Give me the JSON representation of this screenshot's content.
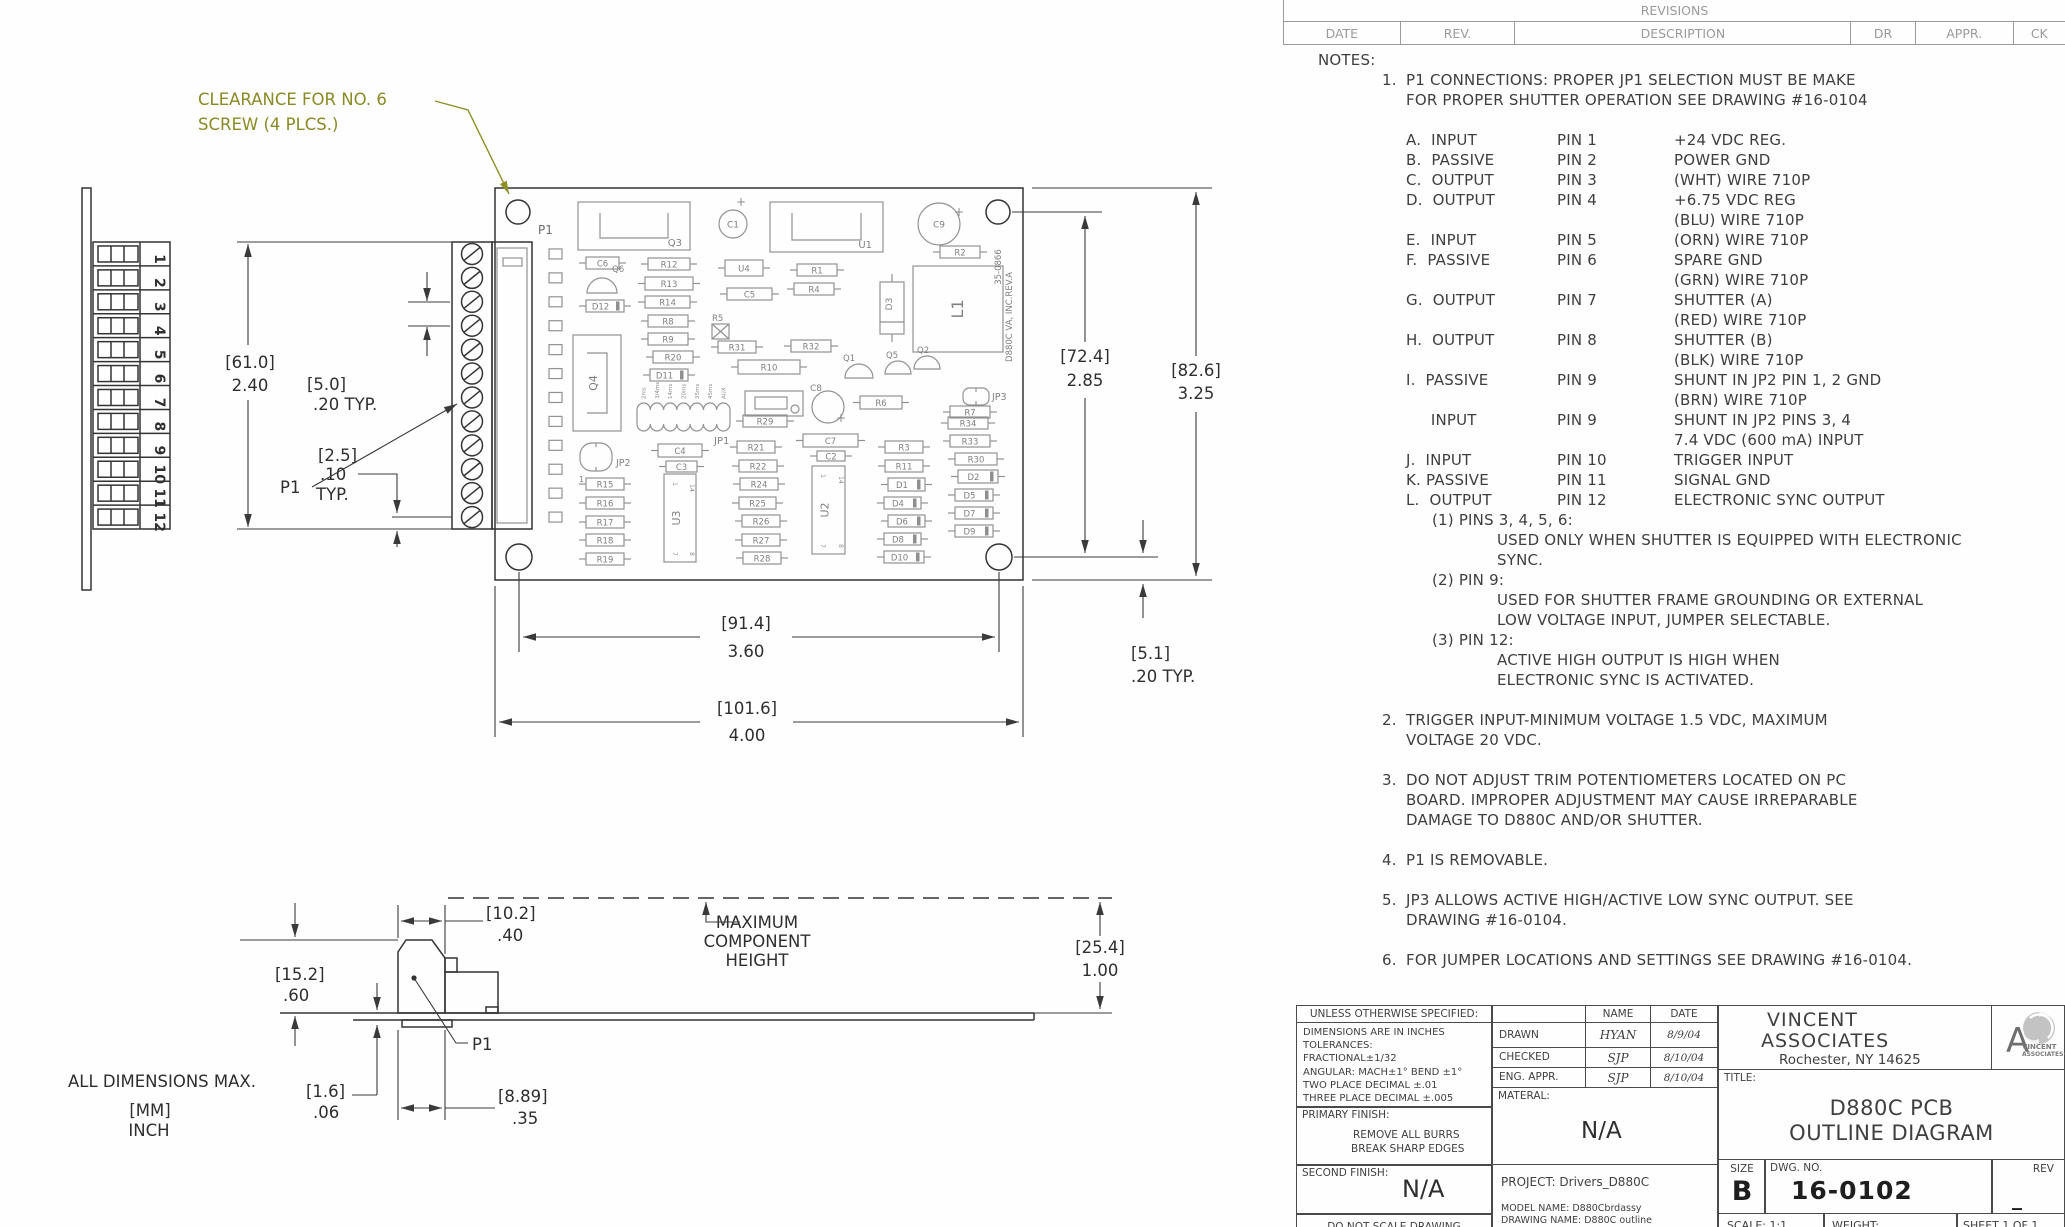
{
  "revisions": {
    "title": "REVISIONS",
    "columns": [
      "DATE",
      "REV.",
      "DESCRIPTION",
      "DR",
      "APPR.",
      "CK"
    ]
  },
  "callout": {
    "line1": "CLEARANCE FOR NO. 6",
    "line2": "SCREW (4 PLCS.)"
  },
  "labels": {
    "p1_main": "P1",
    "p1_left": "P1",
    "p1_side": "P1",
    "all_dims": "ALL DIMENSIONS MAX.",
    "mm": "[MM]",
    "inch": "INCH",
    "maxh1": "MAXIMUM",
    "maxh2": "COMPONENT",
    "maxh3": "HEIGHT"
  },
  "dims": {
    "d61_mm": "[61.0]",
    "d61_in": "2.40",
    "d5_mm": "[5.0]",
    "d5_in": ".20   TYP.",
    "d25_mm": "[2.5]",
    "d25_in": ".10",
    "d25_typ": "TYP.",
    "d72_mm": "[72.4]",
    "d72_in": "2.85",
    "d82_mm": "[82.6]",
    "d82_in": "3.25",
    "d91_mm": "[91.4]",
    "d91_in": "3.60",
    "d101_mm": "[101.6]",
    "d101_in": "4.00",
    "d51_mm": "[5.1]",
    "d51_in": ".20  TYP.",
    "d10_mm": "[10.2]",
    "d10_in": ".40",
    "d15_mm": "[15.2]",
    "d15_in": ".60",
    "d16_mm": "[1.6]",
    "d16_in": ".06",
    "d889_mm": "[8.89]",
    "d889_in": ".35",
    "d254_mm": "[25.4]",
    "d254_in": "1.00"
  },
  "connector_numbers": [
    "1",
    "2",
    "3",
    "4",
    "5",
    "6",
    "7",
    "8",
    "9",
    "10",
    "11",
    "12"
  ],
  "pcb": {
    "edge_text1": "35-0866",
    "edge_text2": "D880C  VA, INC.REV.A",
    "jp1_ticks": [
      "2ms",
      "3/4ms",
      "14ms",
      "20ms",
      "35ms",
      "45ms",
      "AUX"
    ],
    "components": [
      {
        "r": "Q3",
        "t": "ic",
        "x": 578,
        "y": 202,
        "w": 112,
        "h": 48,
        "bracket": true,
        "lx": 682,
        "ly": 246
      },
      {
        "r": "U1",
        "t": "ic",
        "x": 770,
        "y": 202,
        "w": 113,
        "h": 50,
        "bracket": true,
        "lx": 872,
        "ly": 248
      },
      {
        "r": "C1",
        "t": "ecap",
        "x": 733,
        "y": 224,
        "rad": 14,
        "px": 741,
        "py": 206
      },
      {
        "r": "C9",
        "t": "ecap",
        "x": 939,
        "y": 224,
        "rad": 21,
        "px": 959,
        "py": 216
      },
      {
        "r": "R2",
        "t": "res",
        "x": 940,
        "y": 246,
        "w": 40,
        "h": 12
      },
      {
        "r": "U4",
        "t": "cap",
        "x": 725,
        "y": 260,
        "w": 38,
        "h": 16
      },
      {
        "r": "C5",
        "t": "cap",
        "x": 727,
        "y": 288,
        "w": 45,
        "h": 12
      },
      {
        "r": "R1",
        "t": "res",
        "x": 797,
        "y": 264,
        "w": 40,
        "h": 12
      },
      {
        "r": "R4",
        "t": "res",
        "x": 794,
        "y": 283,
        "w": 40,
        "h": 12
      },
      {
        "r": "D3",
        "t": "vdiode",
        "x": 880,
        "y": 282,
        "w": 24,
        "h": 52
      },
      {
        "r": "L1",
        "t": "coil",
        "x": 913,
        "y": 266,
        "w": 90,
        "h": 86
      },
      {
        "r": "C6",
        "t": "cap",
        "x": 586,
        "y": 257,
        "w": 33,
        "h": 12
      },
      {
        "r": "Q6",
        "t": "semi",
        "x": 602,
        "y": 293,
        "rad": 15,
        "lx": 612,
        "ly": 272
      },
      {
        "r": "D12",
        "t": "diode",
        "x": 586,
        "y": 300,
        "w": 38,
        "h": 12
      },
      {
        "r": "R12",
        "t": "res",
        "x": 648,
        "y": 258,
        "w": 42,
        "h": 12
      },
      {
        "r": "R13",
        "t": "res",
        "x": 645,
        "y": 277,
        "w": 48,
        "h": 13
      },
      {
        "r": "R14",
        "t": "res",
        "x": 645,
        "y": 296,
        "w": 45,
        "h": 12
      },
      {
        "r": "R8",
        "t": "res",
        "x": 648,
        "y": 315,
        "w": 40,
        "h": 12
      },
      {
        "r": "R5",
        "t": "xbox",
        "x": 712,
        "y": 324,
        "w": 17,
        "h": 15,
        "lx": 712,
        "ly": 321
      },
      {
        "r": "Q4",
        "t": "icv",
        "x": 573,
        "y": 335,
        "w": 48,
        "h": 96
      },
      {
        "r": "R9",
        "t": "res",
        "x": 648,
        "y": 333,
        "w": 40,
        "h": 12
      },
      {
        "r": "R20",
        "t": "res",
        "x": 653,
        "y": 351,
        "w": 40,
        "h": 12
      },
      {
        "r": "D11",
        "t": "diode",
        "x": 650,
        "y": 369,
        "w": 38,
        "h": 12
      },
      {
        "r": "R31",
        "t": "res",
        "x": 718,
        "y": 341,
        "w": 38,
        "h": 12
      },
      {
        "r": "R32",
        "t": "res",
        "x": 791,
        "y": 340,
        "w": 40,
        "h": 12
      },
      {
        "r": "R10",
        "t": "res",
        "x": 738,
        "y": 360,
        "w": 62,
        "h": 14
      },
      {
        "r": "Q1",
        "t": "semi",
        "x": 859,
        "y": 378,
        "rad": 14,
        "lx": 843,
        "ly": 361
      },
      {
        "r": "Q5",
        "t": "semi",
        "x": 898,
        "y": 374,
        "rad": 13,
        "lx": 886,
        "ly": 358
      },
      {
        "r": "Q2",
        "t": "semi",
        "x": 927,
        "y": 369,
        "rad": 13,
        "lx": 917,
        "ly": 353
      },
      {
        "t": "trim",
        "x": 745,
        "y": 391,
        "w": 58,
        "h": 25
      },
      {
        "r": "C8",
        "t": "ecap",
        "x": 828,
        "y": 407,
        "rad": 16,
        "px": 841,
        "py": 422,
        "lx": 810,
        "ly": 391
      },
      {
        "r": "R6",
        "t": "res",
        "x": 860,
        "y": 396,
        "w": 42,
        "h": 13
      },
      {
        "r": "JP3",
        "t": "jmp",
        "x": 963,
        "y": 388,
        "w": 26,
        "h": 17,
        "lx": 992,
        "ly": 400
      },
      {
        "r": "R7",
        "t": "res",
        "x": 950,
        "y": 406,
        "w": 40,
        "h": 12
      },
      {
        "r": "JP1",
        "t": "jp1",
        "x": 637,
        "y": 403,
        "w": 93,
        "h": 28,
        "lx": 714,
        "ly": 444
      },
      {
        "r": "R29",
        "t": "res",
        "x": 743,
        "y": 415,
        "w": 44,
        "h": 12
      },
      {
        "r": "JP2",
        "t": "jmp",
        "x": 580,
        "y": 443,
        "w": 32,
        "h": 28,
        "lx": 616,
        "ly": 466,
        "sub": "1",
        "sx": 579,
        "sy": 482
      },
      {
        "r": "C4",
        "t": "cap",
        "x": 658,
        "y": 444,
        "w": 44,
        "h": 13
      },
      {
        "r": "C3",
        "t": "cap",
        "x": 666,
        "y": 461,
        "w": 31,
        "h": 11
      },
      {
        "r": "R21",
        "t": "res",
        "x": 737,
        "y": 441,
        "w": 38,
        "h": 12
      },
      {
        "r": "R22",
        "t": "res",
        "x": 739,
        "y": 460,
        "w": 38,
        "h": 12
      },
      {
        "r": "R24",
        "t": "res",
        "x": 740,
        "y": 478,
        "w": 38,
        "h": 12
      },
      {
        "r": "R25",
        "t": "res",
        "x": 739,
        "y": 497,
        "w": 37,
        "h": 12
      },
      {
        "r": "R26",
        "t": "res",
        "x": 742,
        "y": 515,
        "w": 38,
        "h": 12
      },
      {
        "r": "R27",
        "t": "res",
        "x": 742,
        "y": 534,
        "w": 38,
        "h": 12
      },
      {
        "r": "R28",
        "t": "res",
        "x": 743,
        "y": 552,
        "w": 38,
        "h": 12
      },
      {
        "r": "R15",
        "t": "res",
        "x": 586,
        "y": 478,
        "w": 38,
        "h": 12
      },
      {
        "r": "R16",
        "t": "res",
        "x": 586,
        "y": 497,
        "w": 38,
        "h": 12
      },
      {
        "r": "R17",
        "t": "res",
        "x": 586,
        "y": 516,
        "w": 38,
        "h": 12
      },
      {
        "r": "R18",
        "t": "res",
        "x": 586,
        "y": 534,
        "w": 38,
        "h": 12
      },
      {
        "r": "R19",
        "t": "res",
        "x": 586,
        "y": 553,
        "w": 38,
        "h": 12
      },
      {
        "r": "U3",
        "t": "dip",
        "x": 664,
        "y": 474,
        "w": 32,
        "h": 88
      },
      {
        "r": "C7",
        "t": "cap",
        "x": 803,
        "y": 434,
        "w": 55,
        "h": 13
      },
      {
        "r": "C2",
        "t": "cap",
        "x": 817,
        "y": 451,
        "w": 28,
        "h": 10
      },
      {
        "r": "U2",
        "t": "dip",
        "x": 812,
        "y": 466,
        "w": 33,
        "h": 88
      },
      {
        "r": "R3",
        "t": "res",
        "x": 885,
        "y": 441,
        "w": 38,
        "h": 12
      },
      {
        "r": "R11",
        "t": "res",
        "x": 885,
        "y": 460,
        "w": 38,
        "h": 12
      },
      {
        "r": "D1",
        "t": "diode",
        "x": 888,
        "y": 478,
        "w": 37,
        "h": 13
      },
      {
        "r": "D4",
        "t": "diode",
        "x": 884,
        "y": 497,
        "w": 37,
        "h": 12
      },
      {
        "r": "D6",
        "t": "diode",
        "x": 888,
        "y": 515,
        "w": 37,
        "h": 12
      },
      {
        "r": "D8",
        "t": "diode",
        "x": 884,
        "y": 533,
        "w": 37,
        "h": 12
      },
      {
        "r": "D10",
        "t": "diode",
        "x": 884,
        "y": 551,
        "w": 40,
        "h": 12
      },
      {
        "r": "R34",
        "t": "res",
        "x": 948,
        "y": 417,
        "w": 40,
        "h": 12
      },
      {
        "r": "R33",
        "t": "res",
        "x": 950,
        "y": 435,
        "w": 40,
        "h": 12
      },
      {
        "r": "R30",
        "t": "res",
        "x": 955,
        "y": 453,
        "w": 42,
        "h": 12
      },
      {
        "r": "D2",
        "t": "diode",
        "x": 958,
        "y": 470,
        "w": 40,
        "h": 13
      },
      {
        "r": "D5",
        "t": "diode",
        "x": 955,
        "y": 489,
        "w": 38,
        "h": 12
      },
      {
        "r": "D7",
        "t": "diode",
        "x": 955,
        "y": 507,
        "w": 38,
        "h": 12
      },
      {
        "r": "D9",
        "t": "diode",
        "x": 955,
        "y": 525,
        "w": 38,
        "h": 12
      }
    ]
  },
  "notes": {
    "heading": "NOTES:",
    "note1": {
      "num": "1.",
      "lines": [
        "P1 CONNECTIONS:  PROPER JP1 SELECTION MUST BE MAKE",
        "FOR PROPER SHUTTER OPERATION SEE  DRAWING #16-0104"
      ]
    },
    "pin_rows": [
      {
        "a": "A.  INPUT",
        "b": "PIN 1",
        "c": "+24 VDC REG."
      },
      {
        "a": "B.  PASSIVE",
        "b": "PIN 2",
        "c": "POWER GND"
      },
      {
        "a": "C.  OUTPUT",
        "b": "PIN 3",
        "c": "(WHT) WIRE 710P"
      },
      {
        "a": "D.  OUTPUT",
        "b": "PIN 4",
        "c": "+6.75 VDC REG"
      },
      {
        "a": "",
        "b": "",
        "c": "(BLU) WIRE 710P"
      },
      {
        "a": "E.  INPUT",
        "b": "PIN 5",
        "c": "(ORN) WIRE 710P"
      },
      {
        "a": "F.  PASSIVE",
        "b": "PIN 6",
        "c": "SPARE GND"
      },
      {
        "a": "",
        "b": "",
        "c": "(GRN) WIRE 710P"
      },
      {
        "a": "G.  OUTPUT",
        "b": "PIN 7",
        "c": "SHUTTER (A)"
      },
      {
        "a": "",
        "b": "",
        "c": "(RED) WIRE 710P"
      },
      {
        "a": "H.  OUTPUT",
        "b": "PIN 8",
        "c": "SHUTTER (B)"
      },
      {
        "a": "",
        "b": "",
        "c": "(BLK) WIRE 710P"
      },
      {
        "a": "I.  PASSIVE",
        "b": "PIN 9",
        "c": "SHUNT IN JP2 PIN 1, 2 GND"
      },
      {
        "a": "",
        "b": "",
        "c": "(BRN) WIRE 710P"
      },
      {
        "a": "     INPUT",
        "b": "PIN 9",
        "c": "SHUNT IN JP2 PINS 3, 4"
      },
      {
        "a": "",
        "b": "",
        "c": "7.4 VDC (600 mA) INPUT"
      },
      {
        "a": "J.  INPUT",
        "b": "PIN 10",
        "c": "TRIGGER INPUT"
      },
      {
        "a": "K. PASSIVE",
        "b": "PIN 11",
        "c": "SIGNAL GND"
      },
      {
        "a": "L.  OUTPUT",
        "b": "PIN 12",
        "c": "ELECTRONIC SYNC OUTPUT"
      }
    ],
    "sub_notes": [
      {
        "head": "(1) PINS 3, 4, 5, 6:",
        "lines": [
          "USED ONLY WHEN SHUTTER IS EQUIPPED WITH ELECTRONIC",
          "SYNC."
        ]
      },
      {
        "head": "(2) PIN 9:",
        "lines": [
          "USED FOR SHUTTER FRAME GROUNDING OR EXTERNAL",
          "LOW VOLTAGE INPUT, JUMPER SELECTABLE."
        ]
      },
      {
        "head": "(3) PIN 12:",
        "lines": [
          "ACTIVE HIGH OUTPUT IS HIGH WHEN",
          "ELECTRONIC SYNC IS ACTIVATED."
        ]
      }
    ],
    "notes_rest": [
      {
        "num": "2.",
        "lines": [
          "TRIGGER INPUT-MINIMUM VOLTAGE 1.5 VDC, MAXIMUM",
          "VOLTAGE 20 VDC."
        ]
      },
      {
        "num": "3.",
        "lines": [
          "DO NOT ADJUST TRIM POTENTIOMETERS LOCATED ON PC",
          "BOARD. IMPROPER ADJUSTMENT MAY CAUSE IRREPARABLE",
          "DAMAGE TO D880C AND/OR SHUTTER."
        ]
      },
      {
        "num": "4.",
        "lines": [
          "P1 IS REMOVABLE."
        ]
      },
      {
        "num": "5.",
        "lines": [
          "JP3 ALLOWS ACTIVE HIGH/ACTIVE LOW SYNC OUTPUT. SEE",
          "DRAWING #16-0104."
        ]
      },
      {
        "num": "6.",
        "lines": [
          "FOR JUMPER LOCATIONS AND SETTINGS SEE DRAWING #16-0104."
        ]
      }
    ]
  },
  "title_block": {
    "unless": "UNLESS OTHERWISE SPECIFIED:",
    "tol_lines": [
      "DIMENSIONS ARE IN INCHES",
      "TOLERANCES:",
      "FRACTIONAL±1/32",
      "ANGULAR: MACH±1°  BEND ±1°",
      "TWO PLACE DECIMAL    ±.01",
      "THREE PLACE DECIMAL  ±.005"
    ],
    "primary_finish_label": "PRIMARY FINISH:",
    "primary_finish_line1": "REMOVE ALL BURRS",
    "primary_finish_line2": "BREAK SHARP EDGES",
    "second_finish_label": "SECOND FINISH:",
    "second_finish_value": "N/A",
    "do_not_scale": "DO NOT SCALE DRAWING",
    "name_header": "NAME",
    "date_header": "DATE",
    "row1_label": "DRAWN",
    "row1_name": "HYAN",
    "row1_date": "8/9/04",
    "row2_label": "CHECKED",
    "row2_name": "SJP",
    "row2_date": "8/10/04",
    "row3_label": "ENG. APPR.",
    "row3_name": "SJP",
    "row3_date": "8/10/04",
    "material_label": "MATERAL:",
    "material_value": "N/A",
    "project": "PROJECT: Drivers_D880C",
    "model_name": "MODEL NAME: D880Cbrdassy",
    "drawing_name": "DRAWING NAME:  D880C outline",
    "company_line1": "VINCENT",
    "company_line2": "ASSOCIATES",
    "company_line3": "Rochester, NY 14625",
    "logo_letter": "A",
    "logo_text1": "VINCENT",
    "logo_text2": "ASSOCIATES®",
    "title_label": "TITLE:",
    "title_line1": "D880C PCB",
    "title_line2": "OUTLINE DIAGRAM",
    "size_label": "SIZE",
    "size_value": "B",
    "dwg_label": "DWG.  NO.",
    "dwg_value": "16-0102",
    "rev_label": "REV",
    "rev_value": "_",
    "scale": "SCALE:  1:1",
    "weight": "WEIGHT:",
    "sheet": "SHEET 1 OF 1"
  }
}
